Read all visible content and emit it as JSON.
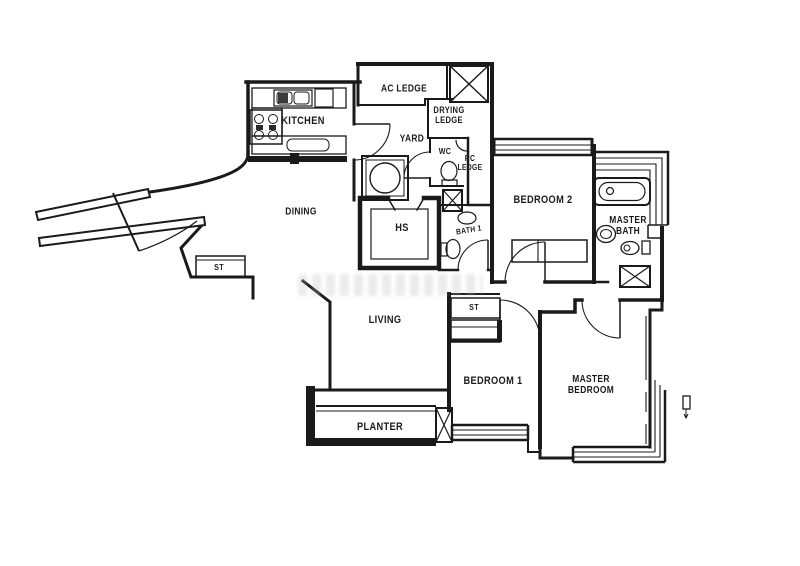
{
  "colors": {
    "wall": "#1a1a1a",
    "background": "#ffffff",
    "watermark": "#b9b9b9"
  },
  "rooms": {
    "kitchen": {
      "label": "KITCHEN"
    },
    "ac_ledge": {
      "label": "AC LEDGE"
    },
    "drying_ledge": {
      "line1": "DRYING",
      "line2": "LEDGE"
    },
    "yard": {
      "label": "YARD"
    },
    "wc": {
      "label": "WC"
    },
    "rc_ledge": {
      "line1": "RC",
      "line2": "LEDGE"
    },
    "dining": {
      "label": "DINING"
    },
    "household_shelter": {
      "label": "HS"
    },
    "bath1": {
      "label": "BATH 1"
    },
    "bedroom2": {
      "label": "BEDROOM 2"
    },
    "master_bath": {
      "line1": "MASTER",
      "line2": "BATH"
    },
    "store_entry": {
      "label": "ST"
    },
    "store_hall": {
      "label": "ST"
    },
    "living": {
      "label": "LIVING"
    },
    "bedroom1": {
      "label": "BEDROOM 1"
    },
    "master_bedroom": {
      "line1": "MASTER",
      "line2": "BEDROOM"
    },
    "planter": {
      "label": "PLANTER"
    }
  },
  "fixtures": [
    "kitchen-double-sink",
    "stove-4-burner",
    "kitchen-counter",
    "washing-machine",
    "wc-toilet",
    "wc-corner-basin",
    "bath1-basin",
    "bath1-toilet",
    "bathtub",
    "master-basin",
    "master-toilet",
    "bedroom2-wardrobe",
    "column-x-drying",
    "column-x-yard",
    "column-x-masterbath",
    "column-x-bedroom1",
    "window-strips",
    "door-swings",
    "entrance-door",
    "balcony-marker"
  ]
}
